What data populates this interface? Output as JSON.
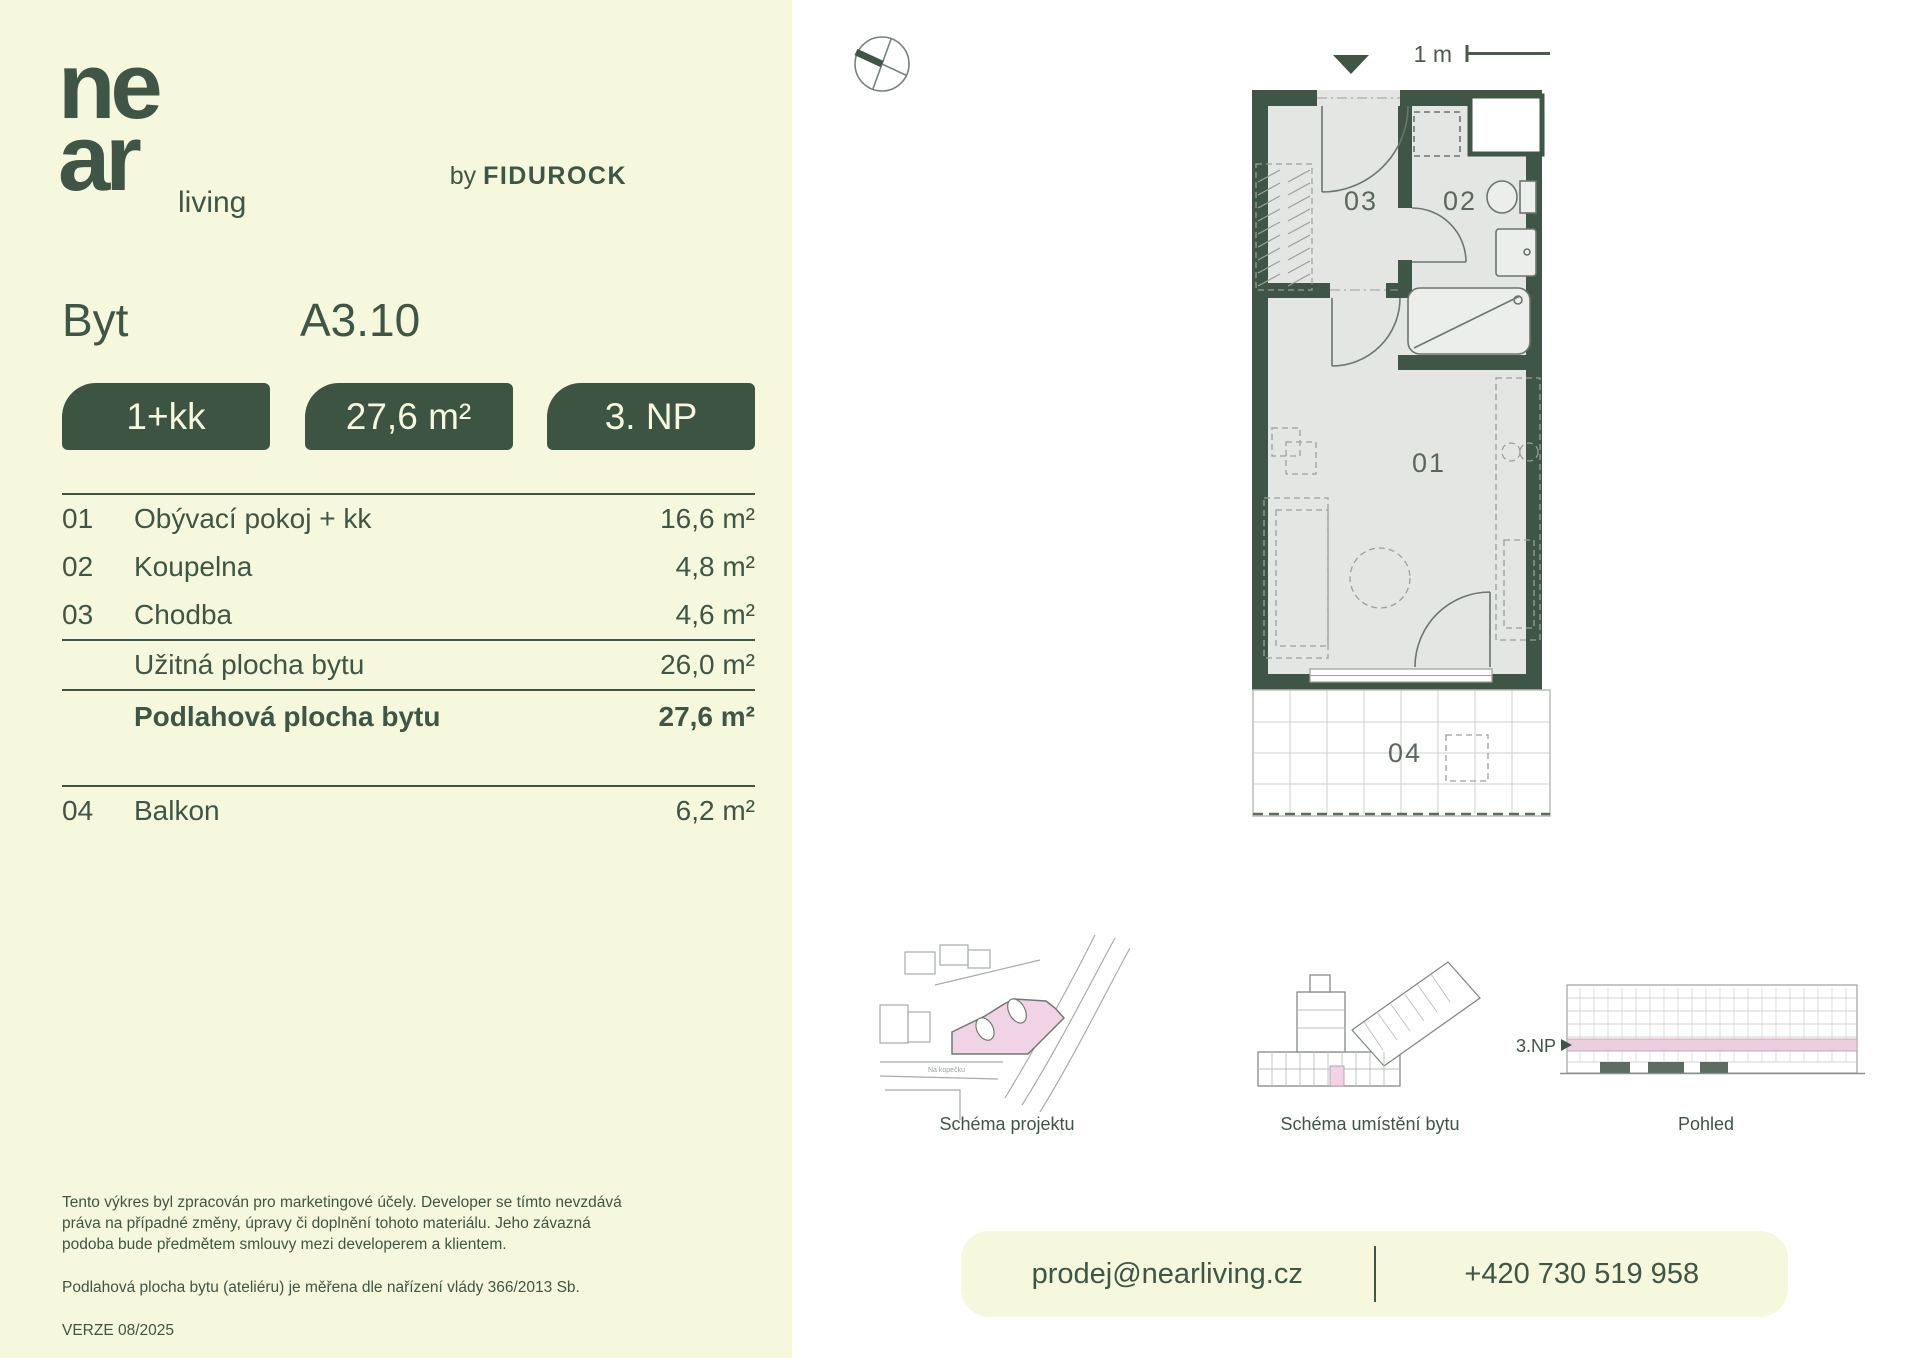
{
  "brand": {
    "logo_line1": "ne",
    "logo_line2": "ar",
    "logo_suffix": "living",
    "byline_prefix": "by",
    "byline_brand": "FIDUROCK"
  },
  "header": {
    "label": "Byt",
    "unit": "A3.10",
    "orientation": "JZ"
  },
  "badges": {
    "layout": "1+kk",
    "area": "27,6 m²",
    "floor": "3. NP"
  },
  "rooms": [
    {
      "num": "01",
      "name": "Obývací pokoj + kk",
      "area": "16,6 m²"
    },
    {
      "num": "02",
      "name": "Koupelna",
      "area": "4,8 m²"
    },
    {
      "num": "03",
      "name": "Chodba",
      "area": "4,6 m²"
    }
  ],
  "totals": {
    "usable": {
      "name": "Užitná plocha bytu",
      "area": "26,0 m²"
    },
    "floor": {
      "name": "Podlahová plocha bytu",
      "area": "27,6 m²"
    }
  },
  "extras": [
    {
      "num": "04",
      "name": "Balkon",
      "area": "6,2 m²"
    }
  ],
  "plan": {
    "scale_label": "1 m",
    "room_labels": {
      "r01": "01",
      "r02": "02",
      "r03": "03",
      "r04": "04"
    }
  },
  "schematics": [
    {
      "caption": "Schéma projektu",
      "street_label": "Na kopečku"
    },
    {
      "caption": "Schéma umístění bytu"
    },
    {
      "caption": "Pohled",
      "floor_label": "3.NP"
    }
  ],
  "footer": {
    "disclaimer1": "Tento výkres byl zpracován pro marketingové účely. Developer se tímto nevzdává práva na případné změny, úpravy či doplnění tohoto materiálu. Jeho závazná podoba bude předmětem smlouvy mezi developerem a klientem.",
    "disclaimer2": "Podlahová plocha bytu (ateliéru) je měřena dle nařízení vlády 366/2013 Sb.",
    "version": "VERZE 08/2025"
  },
  "contact": {
    "email": "prodej@nearliving.cz",
    "phone": "+420 730 519 958"
  },
  "colors": {
    "background": "#f5f8dc",
    "accent_green": "#3e5443",
    "plan_interior": "#e4e6e3",
    "highlight_pink": "#f0d4e5"
  }
}
